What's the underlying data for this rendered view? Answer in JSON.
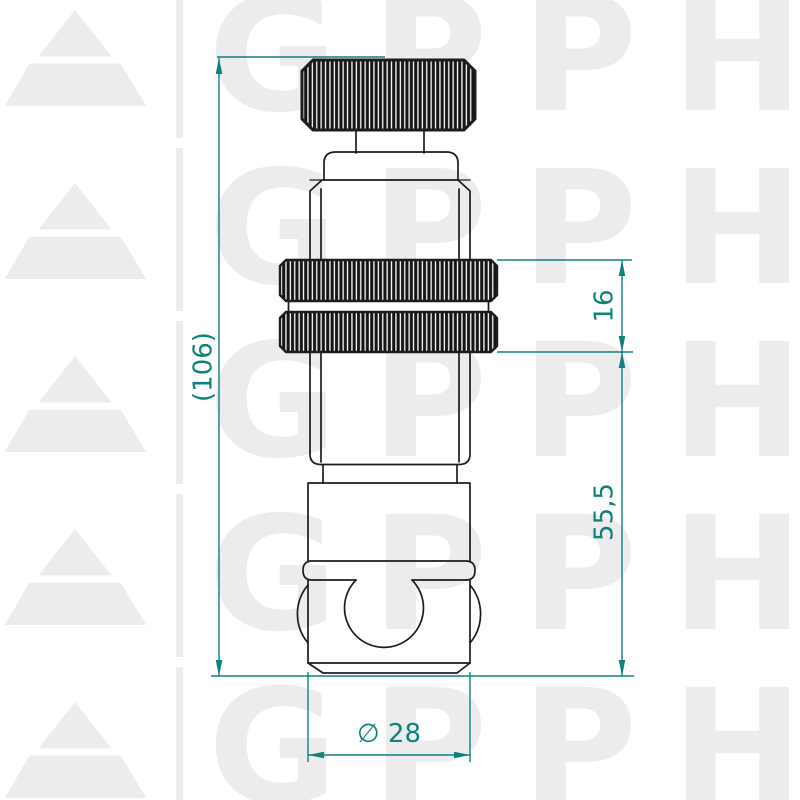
{
  "watermark": {
    "text": "GPPH",
    "color": "#ececec",
    "rows": 5,
    "logo": "triangle-mountain-logo"
  },
  "drawing": {
    "description": "technical side view of knurled clamping bolt with ball socket",
    "parts": [
      "knurled-knob",
      "stem",
      "collar",
      "upper-body",
      "double-knurled-ring",
      "lower-body",
      "socket-block",
      "ball-socket"
    ]
  },
  "dimensions": {
    "overall_height": "(106)",
    "knurl_section_height": "16",
    "lower_section_height": "55,5",
    "diameter": "∅ 28"
  },
  "colors": {
    "dimension": "#0d827d",
    "outline": "#1c1c1c",
    "watermark": "#ececec",
    "background": "#ffffff"
  }
}
